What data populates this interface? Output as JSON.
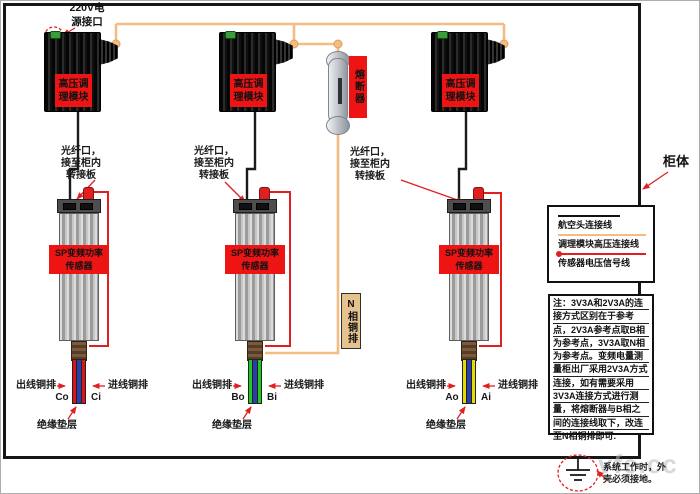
{
  "colors": {
    "wire_hv": "#f2bc83",
    "wire_signal": "#e02020",
    "wire_black": "#1b1b1b",
    "label_red_bg": "#ee1414",
    "phase_a": "#e6d900",
    "phase_b": "#22c822",
    "phase_c": "#dd1414",
    "insulator": "#2a3fae",
    "n_bar_bg": "#e6c38e"
  },
  "top": {
    "power_port_label": "220V电\n源接口",
    "cabinet_label": "柜体"
  },
  "modules": [
    {
      "label": "高压调\n理模块"
    },
    {
      "label": "高压调\n理模块"
    },
    {
      "label": "高压调\n理模块"
    }
  ],
  "fuse": {
    "label": "熔断器"
  },
  "n_busbar": {
    "label": "N相铜排"
  },
  "sensors": [
    {
      "fiber_label": "光纤口，\n接至柜内\n转接板",
      "name_label": "SP变频功率\n传感器",
      "out_label": "出线铜排",
      "in_label": "进线铜排",
      "out_terminal": "Co",
      "in_terminal": "Ci",
      "insulation_label": "绝缘垫层"
    },
    {
      "fiber_label": "光纤口，\n接至柜内\n转接板",
      "name_label": "SP变频功率\n传感器",
      "out_label": "出线铜排",
      "in_label": "进线铜排",
      "out_terminal": "Bo",
      "in_terminal": "Bi",
      "insulation_label": "绝缘垫层"
    },
    {
      "fiber_label": "光纤口，\n接至柜内\n转接板",
      "name_label": "SP变频功率\n传感器",
      "out_label": "出线铜排",
      "in_label": "进线铜排",
      "out_terminal": "Ao",
      "in_terminal": "Ai",
      "insulation_label": "绝缘垫层"
    }
  ],
  "legend": {
    "items": [
      {
        "label": "航空头连接线"
      },
      {
        "label": "调理模块高压连接线"
      },
      {
        "label": "传感器电压信号线"
      }
    ]
  },
  "note": {
    "lines": [
      "注：3V3A和2V3A的连",
      "接方式区别在于参考",
      "点，2V3A参考点取B相",
      "为参考点，3V3A取N相",
      "为参考点。变频电量测",
      "量柜出厂采用2V3A方式",
      "连接，如有需要采用",
      "3V3A连接方式进行测",
      "量，将熔断器与B相之",
      "间的连接线取下，改连",
      "至N相铜排即可."
    ]
  },
  "ground_note": "系统工作时，外\n壳必须接地。",
  "watermark": "vfe.cc"
}
